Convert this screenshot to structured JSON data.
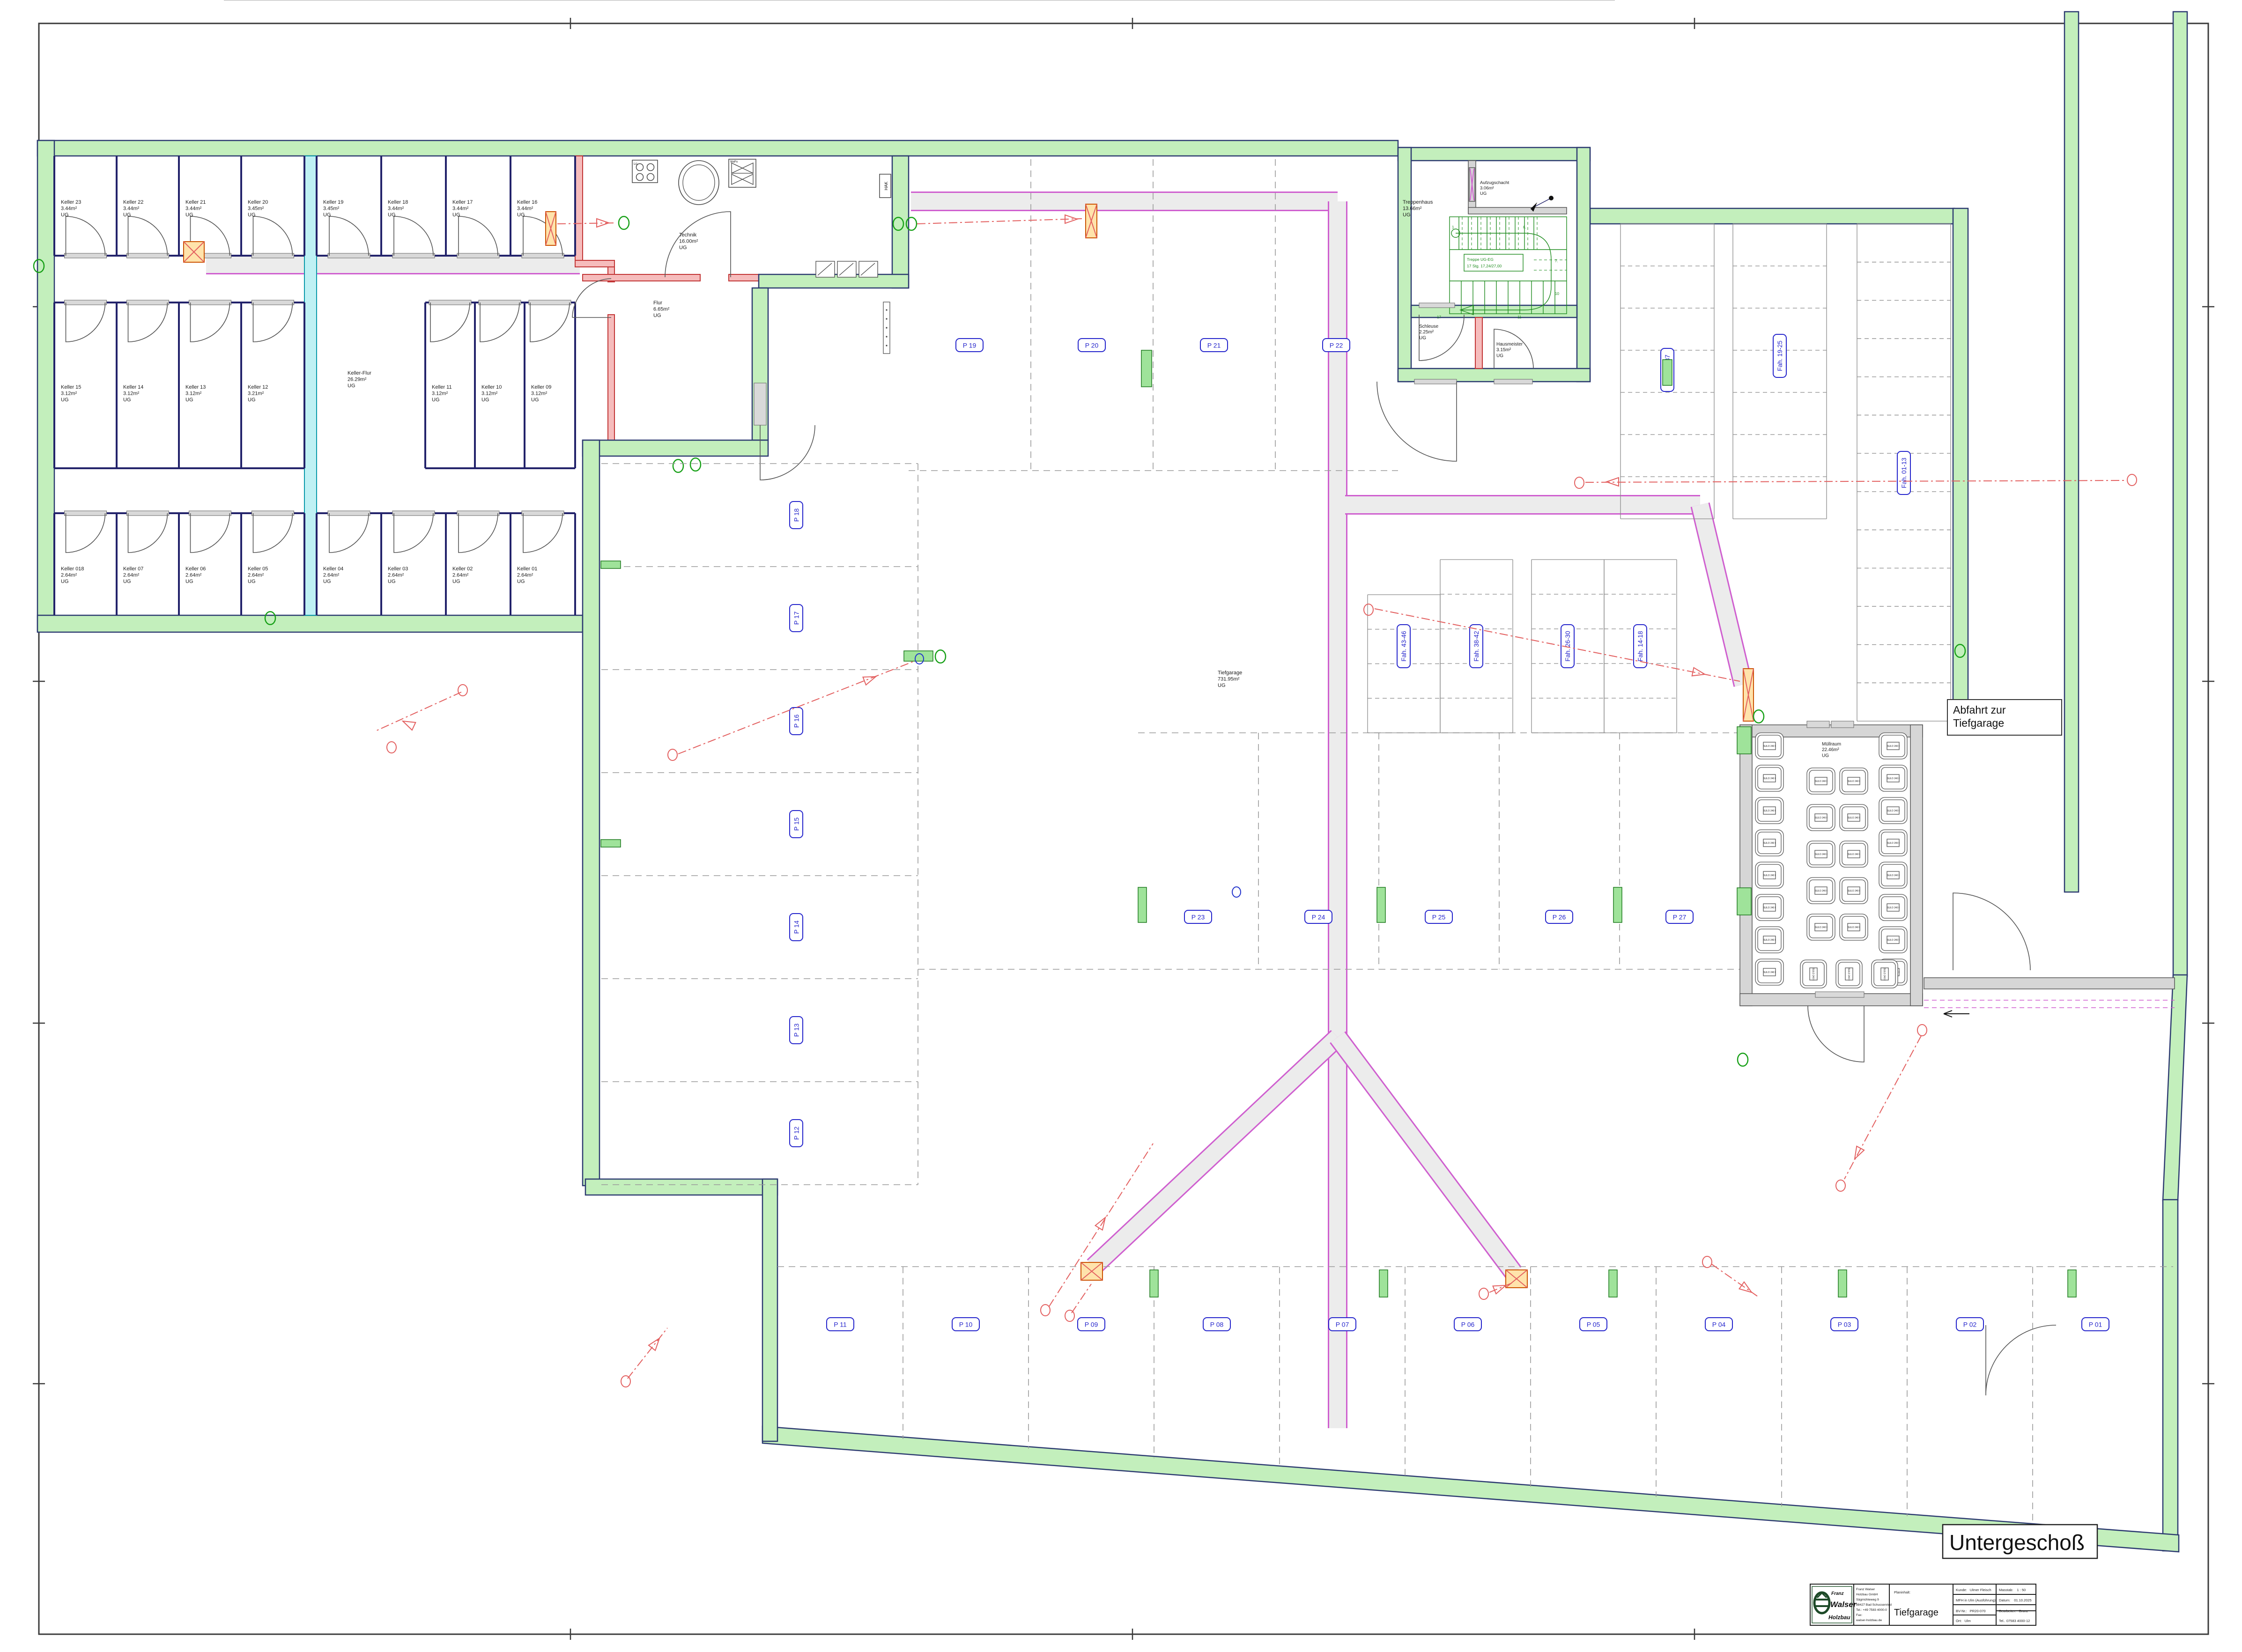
{
  "sheet": {
    "floor_label": "Untergeschoß"
  },
  "annotations": {
    "abfahrt_line1": "Abfahrt zur",
    "abfahrt_line2": "Tiefgarage",
    "hak": "HAK",
    "lue": "Lü",
    "wapu": "WaPu",
    "bin_label": "SULO 240 l"
  },
  "rooms": {
    "technik": {
      "name": "Technik",
      "area": "16.00m²",
      "level": "UG"
    },
    "flur": {
      "name": "Flur",
      "area": "6.65m²",
      "level": "UG"
    },
    "keller_flur": {
      "name": "Keller-Flur",
      "area": "26.29m²",
      "level": "UG"
    },
    "treppenhaus": {
      "name": "Treppenhaus",
      "area": "13.66m²",
      "level": "UG"
    },
    "aufzugschacht": {
      "name": "Aufzugschacht",
      "area": "3.06m²",
      "level": "UG"
    },
    "schleuse": {
      "name": "Schleuse",
      "area": "2.25m²",
      "level": "UG"
    },
    "hausmeister": {
      "name": "Hausmeister",
      "area": "3.15m²",
      "level": "UG"
    },
    "tiefgarage": {
      "name": "Tiefgarage",
      "area": "731.95m²",
      "level": "UG"
    },
    "muellraum": {
      "name": "Müllraum",
      "area": "22.46m²",
      "level": "UG"
    }
  },
  "keller": {
    "top_row": [
      {
        "name": "Keller 23",
        "area": "3.44m²",
        "level": "UG"
      },
      {
        "name": "Keller 22",
        "area": "3.44m²",
        "level": "UG"
      },
      {
        "name": "Keller 21",
        "area": "3.44m²",
        "level": "UG"
      },
      {
        "name": "Keller 20",
        "area": "3.45m²",
        "level": "UG"
      },
      {
        "name": "Keller 19",
        "area": "3.45m²",
        "level": "UG"
      },
      {
        "name": "Keller 18",
        "area": "3.44m²",
        "level": "UG"
      },
      {
        "name": "Keller 17",
        "area": "3.44m²",
        "level": "UG"
      },
      {
        "name": "Keller 16",
        "area": "3.44m²",
        "level": "UG"
      }
    ],
    "mid_left": [
      {
        "name": "Keller 15",
        "area": "3.12m²",
        "level": "UG"
      },
      {
        "name": "Keller 14",
        "area": "3.12m²",
        "level": "UG"
      },
      {
        "name": "Keller 13",
        "area": "3.12m²",
        "level": "UG"
      },
      {
        "name": "Keller 12",
        "area": "3.21m²",
        "level": "UG"
      }
    ],
    "mid_right": [
      {
        "name": "Keller 11",
        "area": "3.12m²",
        "level": "UG"
      },
      {
        "name": "Keller 10",
        "area": "3.12m²",
        "level": "UG"
      },
      {
        "name": "Keller 09",
        "area": "3.12m²",
        "level": "UG"
      }
    ],
    "bottom_row": [
      {
        "name": "Keller 018",
        "area": "2.64m²",
        "level": "UG"
      },
      {
        "name": "Keller 07",
        "area": "2.64m²",
        "level": "UG"
      },
      {
        "name": "Keller 06",
        "area": "2.64m²",
        "level": "UG"
      },
      {
        "name": "Keller 05",
        "area": "2.64m²",
        "level": "UG"
      },
      {
        "name": "Keller 04",
        "area": "2.64m²",
        "level": "UG"
      },
      {
        "name": "Keller 03",
        "area": "2.64m²",
        "level": "UG"
      },
      {
        "name": "Keller 02",
        "area": "2.64m²",
        "level": "UG"
      },
      {
        "name": "Keller 01",
        "area": "2.64m²",
        "level": "UG"
      }
    ]
  },
  "parking": {
    "top": [
      "P 19",
      "P 20",
      "P 21",
      "P 22"
    ],
    "left_col": [
      "P 18",
      "P 17",
      "P 16",
      "P 15",
      "P 14",
      "P 13",
      "P 12"
    ],
    "middle": [
      "P 23",
      "P 24",
      "P 25",
      "P 26",
      "P 27"
    ],
    "bottom": [
      "P 11",
      "P 10",
      "P 09",
      "P 08",
      "P 07",
      "P 06",
      "P 05",
      "P 04",
      "P 03",
      "P 02",
      "P 01"
    ]
  },
  "bike_racks": [
    "Fah. 43-46",
    "Fah. 38-42",
    "Fah. 26-30",
    "Fah. 14-18",
    "Fah. 31-37",
    "Fah. 19-25",
    "Fah. 01-13"
  ],
  "stairs": {
    "note_line1": "Treppe UG-EG",
    "note_line2": "17 Stg. 17,24/27,00",
    "steps": [
      "1",
      "6.",
      "7.",
      "10",
      "11",
      "17"
    ]
  },
  "title_block": {
    "logo_line1": "Franz",
    "logo_line2": "Walser",
    "logo_line3": "Holzbau",
    "company_lines": [
      "Franz Walser",
      "Holzbau GmbH",
      "Sägmühleweg 9",
      "88427 Bad Schussenried",
      "Tel.: +49 7583 4000-0",
      "Fax:",
      "walser-holzbau.de"
    ],
    "planinhalt_label": "Planinhalt:",
    "planinhalt_value": "Tiefgarage",
    "kunde_label": "Kunde:",
    "kunde_value": "Ulmer Fleisch",
    "projekt": "MFH in Ulm (Ausführung)",
    "bv_label": "BV-Nr.:",
    "bv_value": "PR20-070",
    "ort_label": "Ort:",
    "ort_value": "Ulm",
    "masstab_label": "Masstab:",
    "masstab_value": "1 : 50",
    "datum_label": "Datum:",
    "datum_value": "01.10.2025",
    "bearbeiter_label": "Bearbeiter:",
    "bearbeiter_value": "Branz",
    "tel": "Tel.. 07583 4000-12"
  }
}
